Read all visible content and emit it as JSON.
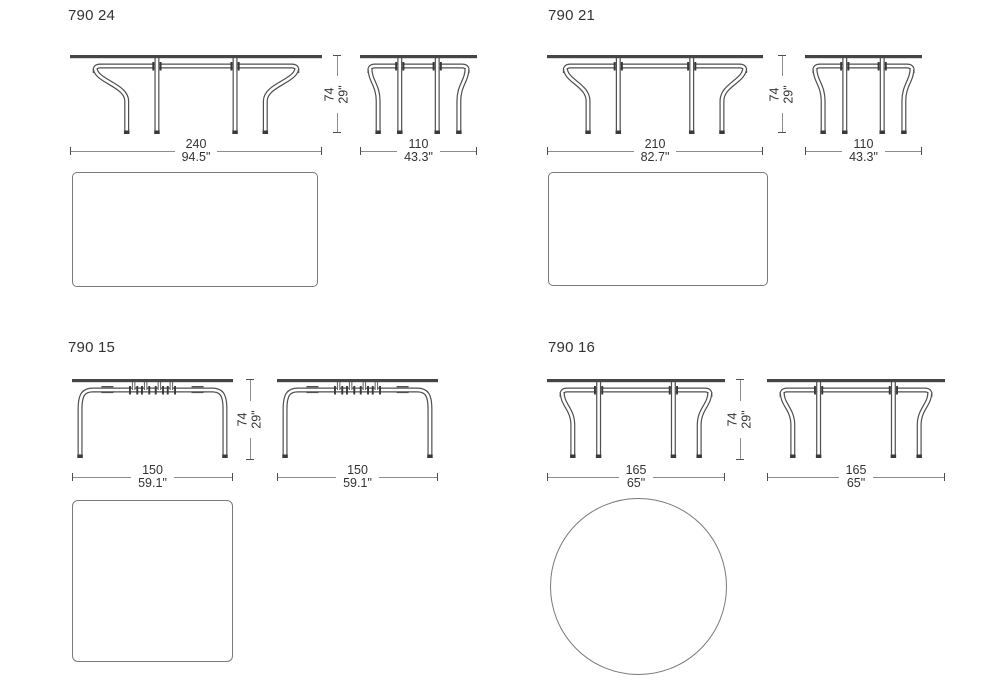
{
  "sections": [
    {
      "title": "790 24",
      "front": {
        "cm": "240",
        "inch": "94.5\""
      },
      "side": {
        "cm": "110",
        "inch": "43.3\""
      },
      "height": {
        "cm": "74",
        "inch": "29\""
      },
      "plan_shape": "rectangle"
    },
    {
      "title": "790 21",
      "front": {
        "cm": "210",
        "inch": "82.7\""
      },
      "side": {
        "cm": "110",
        "inch": "43.3\""
      },
      "height": {
        "cm": "74",
        "inch": "29\""
      },
      "plan_shape": "rectangle"
    },
    {
      "title": "790 15",
      "front": {
        "cm": "150",
        "inch": "59.1\""
      },
      "side": {
        "cm": "150",
        "inch": "59.1\""
      },
      "height": {
        "cm": "74",
        "inch": "29\""
      },
      "plan_shape": "square"
    },
    {
      "title": "790 16",
      "front": {
        "cm": "165",
        "inch": "65\""
      },
      "side": {
        "cm": "165",
        "inch": "65\""
      },
      "height": {
        "cm": "74",
        "inch": "29\""
      },
      "plan_shape": "circle"
    }
  ],
  "colors": {
    "text": "#333333",
    "dim_line": "#8c8c8c",
    "dim_tick": "#4f4f4f",
    "drawing_outline": "#4f4f4f",
    "tabletop_fill": "#454545",
    "plan_border": "#7a7a7a",
    "background": "#ffffff"
  }
}
